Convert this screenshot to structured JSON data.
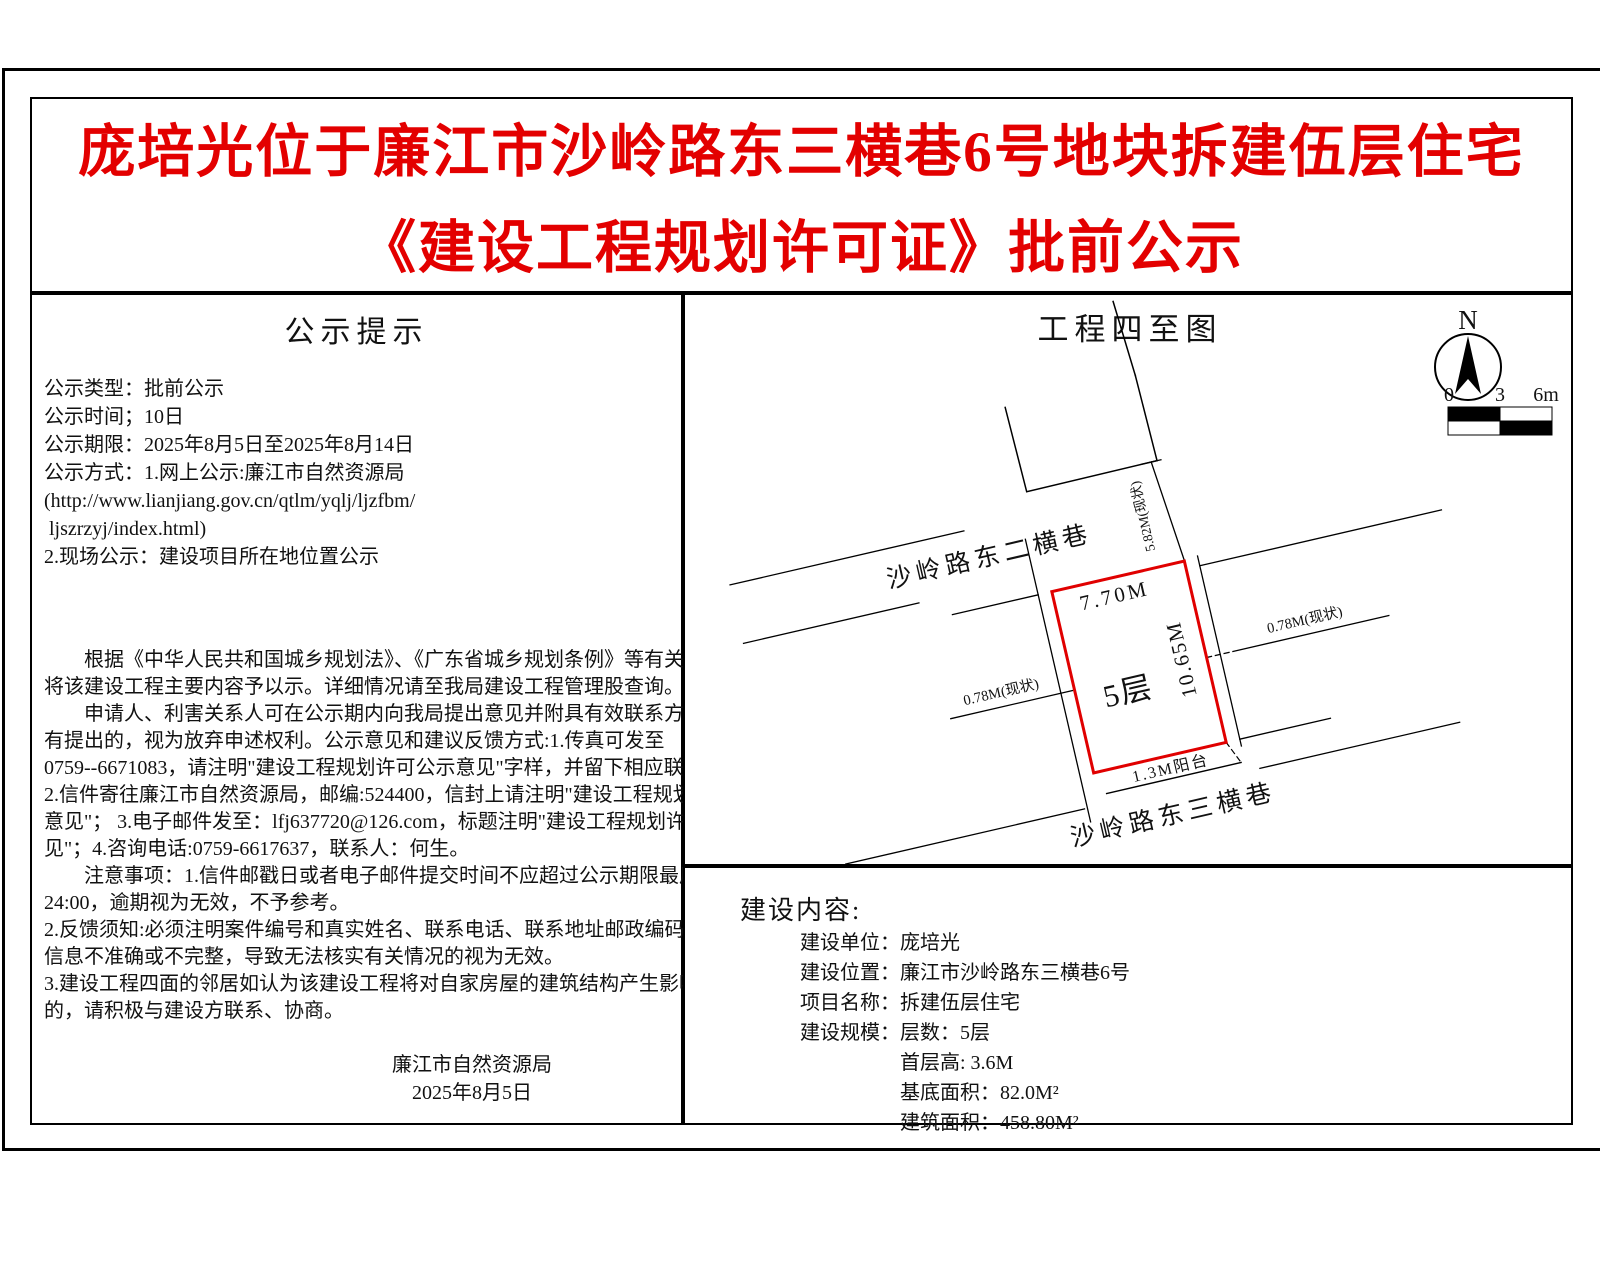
{
  "title": {
    "line1": "庞培光位于廉江市沙岭路东三横巷6号地块拆建伍层住宅",
    "line2": "《建设工程规划许可证》批前公示"
  },
  "colors": {
    "title_red": "#e30000",
    "parcel_red": "#e00000",
    "line_black": "#000000"
  },
  "left_panel": {
    "heading": "公示提示",
    "info_lines": [
      "公示类型：批前公示",
      "公示时间；10日",
      "公示期限：2025年8月5日至2025年8月14日",
      "公示方式：1.网上公示:廉江市自然资源局",
      "(http://www.lianjiang.gov.cn/qtlm/yqlj/ljzfbm/",
      " ljszrzyj/index.html)",
      "2.现场公示：建设项目所在地位置公示"
    ],
    "body_lines": [
      "　　根据《中华人民共和国城乡规划法》、《广东省城乡规划条例》等有关规定，现",
      "将该建设工程主要内容予以示。详细情况请至我局建设工程管理股查询。",
      "　　申请人、利害关系人可在公示期内向我局提出意见并附具有效联系方式，逾期没",
      "有提出的，视为放弃申述权利。公示意见和建议反馈方式:1.传真可发至",
      "0759--6671083，请注明\"建设工程规划许可公示意见\"字样，并留下相应联系方式；",
      "2.信件寄往廉江市自然资源局，邮编:524400，信封上请注明\"建设工程规划许可公示",
      "意见\"； 3.电子邮件发至：lfj637720@126.com，标题注明\"建设工程规划许可公示意",
      "见\"；4.咨询电话:0759-6617637，联系人：何生。",
      "　　注意事项：1.信件邮戳日或者电子邮件提交时间不应超过公示期限最后一天的",
      "24:00，逾期视为无效，不予参考。",
      "2.反馈须知:必须注明案件编号和真实姓名、联系电话、联系地址邮政编码，如反馈",
      "信息不准确或不完整，导致无法核实有关情况的视为无效。",
      "3.建设工程四面的邻居如认为该建设工程将对自家房屋的建筑结构产生影响、破坏",
      "的，请积极与建设方联系、协商。"
    ],
    "signature": [
      "廉江市自然资源局",
      "2025年8月5日"
    ]
  },
  "site_panel": {
    "heading": "工程四至图",
    "compass_label": "N",
    "scale_labels": [
      "0",
      "3",
      "6m"
    ],
    "plan": {
      "north_street": "沙岭路东二横巷",
      "south_street": "沙岭路东三横巷",
      "building_label": "5层",
      "top_dim": "7.70M",
      "right_dim": "10.65M",
      "gap_north": "5.82M(现状)",
      "gap_west": "0.78M(现状)",
      "gap_east": "0.78M(现状)",
      "balcony": "1.3M阳台"
    }
  },
  "content_panel": {
    "heading": "建设内容:",
    "lines": [
      "建设单位：庞培光",
      "建设位置：廉江市沙岭路东三横巷6号",
      "项目名称：拆建伍层住宅",
      "建设规模：层数：5层",
      "　　　　　首层高: 3.6M",
      "　　　　　基底面积：82.0M²",
      "　　　　　建筑面积：458.80M²"
    ]
  }
}
